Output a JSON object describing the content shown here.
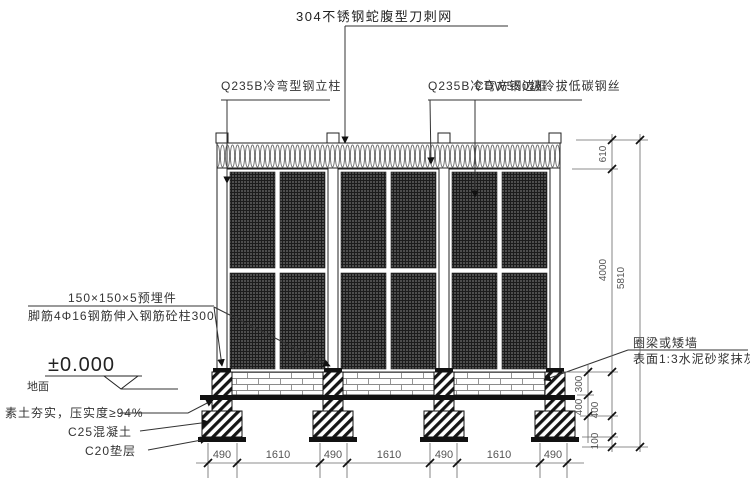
{
  "annotations": {
    "top": {
      "razor": "304不锈钢蛇腹型刀刺网",
      "post": "Q235B冷弯型钢立柱",
      "frame": "Q235B冷弯方钢边框",
      "wire": "CDW550级冷拔低碳钢丝"
    },
    "left": {
      "embed_plate": "150×150×5预埋件",
      "anchor_bar": "脚筋4Φ16钢筋伸入钢筋砼柱300",
      "level": "±0.000",
      "ground": "地面",
      "soil": "素土夯实，压实度≥94%",
      "concrete": "C25混凝土",
      "cushion": "C20垫层"
    },
    "right": {
      "beam": "圈梁或矮墙",
      "plaster": "表面1:3水泥砂浆抹灰"
    }
  },
  "dimensions": {
    "razor_height": "610",
    "panel_height": "4000",
    "total_height": "5810",
    "wall_height": "300",
    "depth_a": "400",
    "depth_b": "400",
    "cushion_depth": "100",
    "bottom": [
      "490",
      "1610",
      "490",
      "1610",
      "490",
      "1610",
      "490"
    ]
  }
}
